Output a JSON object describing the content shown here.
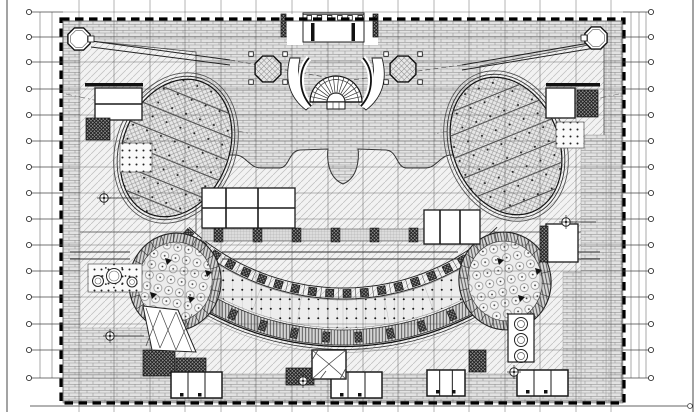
{
  "meta": {
    "kind": "architectural-floor-plan-cad",
    "canvas": {
      "w": 700,
      "h": 412
    }
  },
  "palette": {
    "paper": "#ffffff",
    "ink": "#1a1a1a",
    "grid": "#3a3a3a",
    "light": "#bdbdbd"
  },
  "sheet": {
    "left_x": 7,
    "right_x": 693,
    "bottom_rule": {
      "y": 406,
      "x1": 30,
      "x2": 687,
      "end_circle_x": 690
    }
  },
  "grid": {
    "vertical_xs": [
      79,
      114,
      150,
      185,
      221,
      256,
      292,
      328,
      363,
      398,
      434,
      469,
      505,
      540,
      576,
      611
    ],
    "horizontal_ys": [
      12,
      37,
      62,
      89,
      115,
      141,
      167,
      193,
      219,
      245,
      271,
      297,
      324,
      350,
      378
    ],
    "bubbles": {
      "left_x": 29,
      "right_x": 651,
      "r": 2.6
    },
    "left_rules_x": [
      40,
      52
    ],
    "right_rules_x": [
      631,
      639,
      646
    ]
  },
  "building": {
    "x": 61,
    "y": 19,
    "w": 563,
    "h": 384,
    "dash": "8.5 5.5"
  },
  "terrace": {
    "path": "M63,21 L623,21 L623,155 L451,155 C440,155 437,168 425,168 L407,168 C396,168 398,151 386,150 L358,149 C358,149 362,176 343,184 C324,176 328,149 328,149 L300,150 C288,151 290,168 279,168 L261,168 C249,168 246,155 235,155 L63,155 Z",
    "edge": "M623,155 L451,155 C440,155 437,168 425,168 L407,168 C396,168 398,151 386,150 L358,149 C358,149 362,176 343,184 C324,176 328,149 328,149 L300,150 C288,151 290,168 279,168 L261,168 C249,168 246,155 235,155 L63,155"
  },
  "wedges": [
    {
      "pts": "63,38 196,52 196,232 63,232"
    },
    {
      "pts": "604,42 480,66 480,232 604,232"
    }
  ],
  "ramps": {
    "solid": [
      [
        91,
        41,
        230,
        60
      ],
      [
        91,
        47,
        230,
        65
      ],
      [
        601,
        41,
        462,
        65
      ],
      [
        601,
        47,
        462,
        70
      ]
    ],
    "dashed": [
      [
        230,
        60,
        336,
        79
      ],
      [
        462,
        65,
        352,
        80
      ]
    ],
    "dashdot": [
      [
        66,
        94,
        252,
        134
      ],
      [
        619,
        94,
        434,
        134
      ]
    ]
  },
  "bricks": [
    [
      63,
      21,
      17,
      382
    ],
    [
      606,
      21,
      17,
      382
    ],
    [
      63,
      374,
      560,
      29
    ],
    [
      581,
      135,
      25,
      268
    ],
    [
      563,
      272,
      18,
      106
    ],
    [
      63,
      328,
      107,
      46
    ]
  ],
  "amphitheater": {
    "cx": 343,
    "cy": 62,
    "dot_band": {
      "r1": 238,
      "r2": 266,
      "a": 40
    },
    "colonnade": {
      "r1": 226,
      "r2": 237,
      "a": 43,
      "pier_r": 231.5,
      "pier_step": 4.3,
      "pier_s": 8
    },
    "wall_band": {
      "r1": 268,
      "r2": 283,
      "a": 40,
      "pier_r": 275.5,
      "pier_step": 6.7
    },
    "edge_rs": [
      284.5,
      287.5,
      290.5
    ],
    "joint_step": 10
  },
  "ellipses_main": [
    {
      "cx": 176,
      "cy": 148,
      "rx": 53,
      "ry": 71,
      "rot": 22
    },
    {
      "cx": 506,
      "cy": 146,
      "rx": 53,
      "ry": 71,
      "rot": -22
    }
  ],
  "ellipse_band_offsets": [
    -52,
    -30,
    -8,
    14,
    36,
    58
  ],
  "ovals": [
    {
      "cx": 175,
      "cy": 282,
      "rx": 46,
      "ry": 49,
      "rot": 12
    },
    {
      "cx": 505,
      "cy": 281,
      "rx": 46,
      "ry": 49,
      "rot": -12
    }
  ],
  "corridor": {
    "y1": 252,
    "y2": 259,
    "segments": [
      [
        70,
        130
      ],
      [
        222,
        458
      ],
      [
        553,
        600
      ]
    ]
  },
  "dotted_band": {
    "x": 202,
    "y": 229,
    "w": 276,
    "h": 12,
    "piers": 7
  },
  "white_rooms": [
    [
      95,
      88,
      47,
      32
    ],
    [
      546,
      88,
      29,
      30
    ],
    [
      202,
      188,
      93,
      40
    ],
    [
      424,
      210,
      56,
      34
    ],
    [
      546,
      224,
      32,
      38
    ]
  ],
  "room_walls": [
    [
      202,
      208,
      295,
      208
    ],
    [
      226,
      188,
      226,
      228
    ],
    [
      258,
      188,
      258,
      228
    ],
    [
      440,
      210,
      440,
      244
    ],
    [
      460,
      210,
      460,
      244
    ],
    [
      95,
      104,
      142,
      104
    ]
  ],
  "wall_bars": [
    [
      85,
      83,
      58,
      3.5
    ],
    [
      546,
      83,
      54,
      3.5
    ]
  ],
  "dark_blocks": [
    [
      86,
      118,
      24,
      22
    ],
    [
      577,
      90,
      21,
      27
    ],
    [
      143,
      350,
      32,
      26
    ],
    [
      176,
      358,
      30,
      18
    ],
    [
      286,
      368,
      28,
      17
    ],
    [
      469,
      350,
      17,
      22
    ],
    [
      540,
      226,
      8,
      36
    ]
  ],
  "dot_squares": [
    [
      120,
      143,
      32,
      29
    ],
    [
      556,
      122,
      28,
      26
    ],
    [
      88,
      264,
      54,
      28
    ]
  ],
  "bottom_rooms": [
    [
      171,
      372,
      51,
      26
    ],
    [
      331,
      372,
      51,
      26
    ],
    [
      427,
      370,
      38,
      26
    ],
    [
      517,
      370,
      51,
      26
    ]
  ],
  "stair": {
    "cx": 336,
    "cy": 102,
    "r_outer": 26,
    "r_mid": 22.5,
    "r_inner": 9,
    "tread_step": 12
  },
  "parentheses": [
    "M309,58 C298,70 298,92 311,106",
    "M363,58 C374,70 374,92 361,106"
  ],
  "leaves": [
    "M290,58 C284,80 290,98 306,110 L313,104 C300,92 296,76 300,58 Z",
    "M382,58 C388,80 382,98 366,110 L359,104 C372,92 376,76 372,58 Z"
  ],
  "octagon_columns": [
    {
      "cx": 268,
      "cy": 69,
      "r": 14
    },
    {
      "cx": 403,
      "cy": 69,
      "r": 14
    }
  ],
  "corner_pavilions": [
    {
      "cx": 79,
      "cy": 39,
      "r": 12
    },
    {
      "cx": 596,
      "cy": 38,
      "r": 12
    }
  ],
  "portico": {
    "x": 303,
    "y": 13,
    "w": 61,
    "h": 29,
    "cols": 6,
    "bars": [
      [
        311,
        23
      ],
      [
        351.5,
        23
      ]
    ],
    "flank": [
      [
        281,
        14
      ],
      [
        373,
        14
      ]
    ],
    "white": [
      [
        287,
        14,
        16,
        31
      ],
      [
        364,
        14,
        14,
        31
      ]
    ]
  },
  "symbols": [
    [
      104,
      198,
      36
    ],
    [
      566,
      222,
      30
    ],
    [
      110,
      336,
      34
    ],
    [
      514,
      372,
      0
    ],
    [
      303,
      381,
      0
    ]
  ],
  "plaza_circles": [
    [
      98,
      281,
      5.5
    ],
    [
      114,
      276,
      7.5
    ],
    [
      132,
      282,
      5
    ]
  ],
  "triple_circles": {
    "x": 508,
    "y": 314,
    "w": 26,
    "h": 48,
    "cx": 521,
    "r": 6.5,
    "ys": [
      324,
      340,
      356
    ]
  },
  "brace_wedge": {
    "pts": "143,306 178,310 196,352 152,350",
    "lines": [
      [
        146,
        308,
        160,
        348
      ],
      [
        160,
        310,
        146,
        346
      ],
      [
        160,
        310,
        176,
        350
      ],
      [
        176,
        312,
        160,
        348
      ],
      [
        176,
        312,
        192,
        352
      ],
      [
        192,
        314,
        176,
        350
      ]
    ]
  },
  "ornament": {
    "x": 312,
    "y": 350,
    "w": 34,
    "h": 29,
    "lines": [
      [
        312,
        350,
        329,
        364
      ],
      [
        346,
        350,
        329,
        364
      ],
      [
        329,
        364,
        312,
        379
      ],
      [
        329,
        364,
        346,
        379
      ],
      [
        318,
        350,
        312,
        360
      ],
      [
        346,
        368,
        340,
        379
      ],
      [
        320,
        379,
        326,
        371
      ]
    ]
  },
  "oval_triangles": [
    [
      165,
      258
    ],
    [
      188,
      296
    ],
    [
      150,
      292
    ],
    [
      205,
      270
    ],
    [
      497,
      258
    ],
    [
      518,
      295
    ],
    [
      535,
      268
    ]
  ],
  "door_dots": [
    [
      180,
      393
    ],
    [
      198,
      393
    ],
    [
      340,
      393
    ],
    [
      358,
      393
    ],
    [
      436,
      390
    ],
    [
      452,
      390
    ],
    [
      526,
      390
    ],
    [
      544,
      390
    ]
  ]
}
